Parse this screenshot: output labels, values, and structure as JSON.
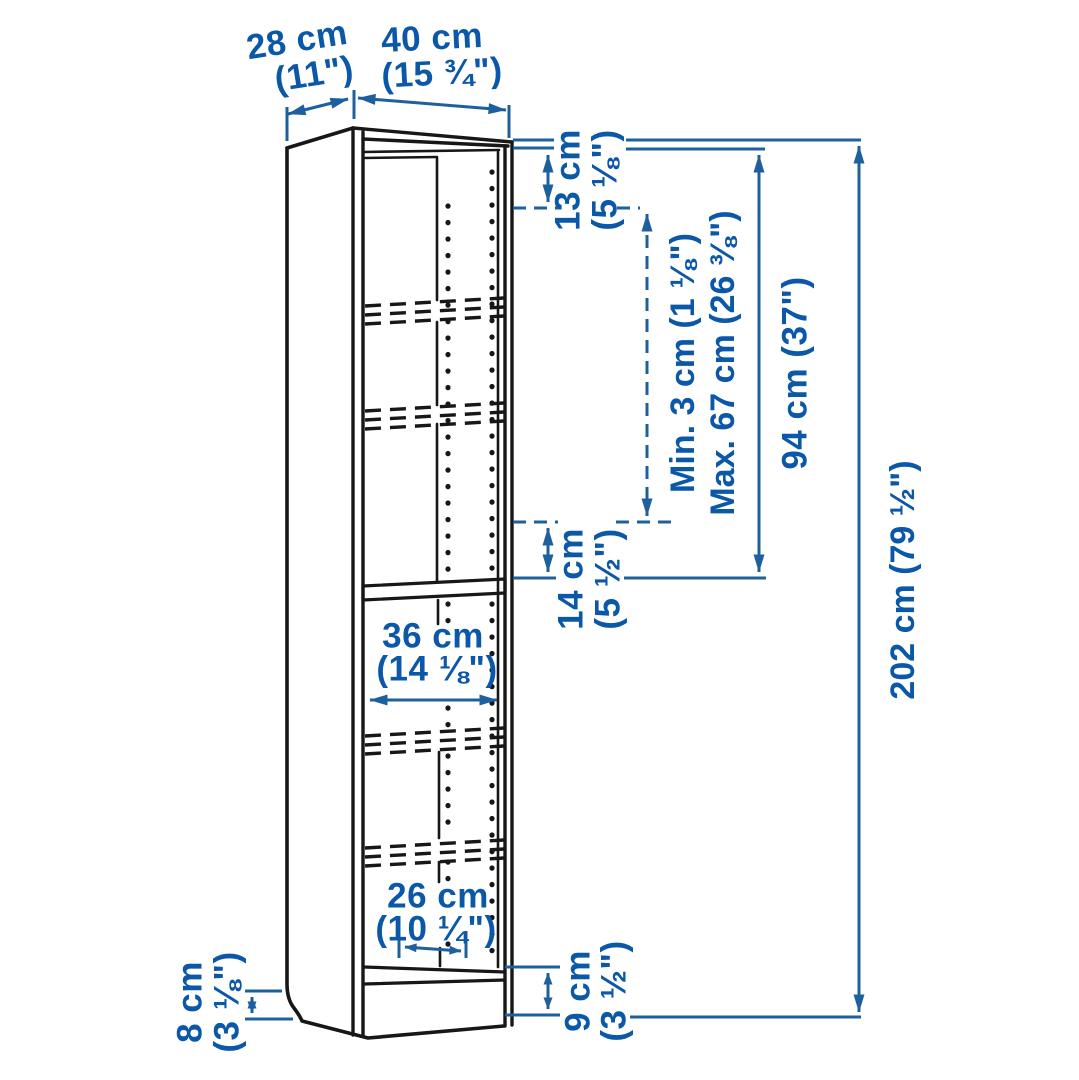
{
  "diagram": {
    "kind": "furniture-dimension-diagram",
    "subject": "tall narrow bookcase with adjustable shelves",
    "background": "#ffffff",
    "colors": {
      "outline": "#171717",
      "dimension_line": "#1e5f9e",
      "dimension_text": "#0b57a8"
    },
    "labels": {
      "depth": {
        "cm": "28 cm",
        "inches": "(11\")"
      },
      "width": {
        "cm": "40 cm",
        "inches": "(15 ¾\")"
      },
      "top_gap": {
        "cm": "13 cm",
        "inches": "(5 ⅛\")"
      },
      "shelf_min": "Min. 3 cm (1 ⅛\")",
      "shelf_max": "Max. 67 cm (26 ⅜\")",
      "upper_section": "94 cm (37\")",
      "shelf_gap": {
        "cm": "14 cm",
        "inches": "(5 ½\")"
      },
      "total_height": "202 cm (79 ½\")",
      "inner_width": {
        "cm": "36 cm",
        "inches": "(14 ⅛\")"
      },
      "bottom_depth": {
        "cm": "26 cm",
        "inches": "(10 ¼\")"
      },
      "plinth_left": {
        "cm": "8 cm",
        "inches": "(3 ⅛\")"
      },
      "plinth_right": {
        "cm": "9 cm",
        "inches": "(3 ½\")"
      }
    }
  }
}
